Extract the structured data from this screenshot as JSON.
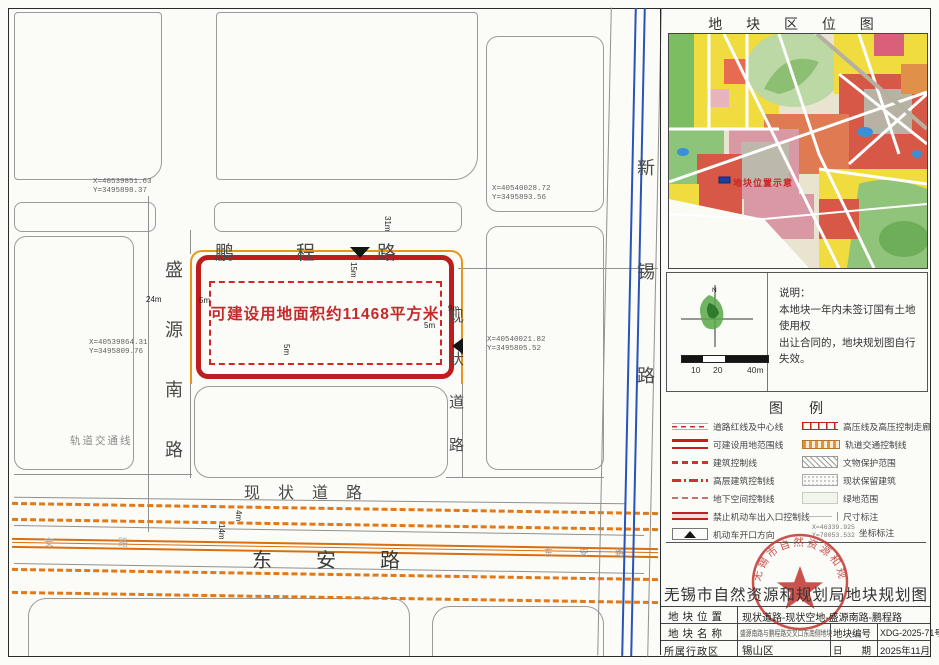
{
  "location_panel": {
    "title": "地 块 区 位 图",
    "map_label": "地块位置示意",
    "north_label": "N",
    "note_title": "说明：",
    "note_line1": "本地块一年内未签订国有土地使用权",
    "note_line2": "出让合同的，地块规划图自行失效。",
    "scale": {
      "t10": "10",
      "t20": "20",
      "t40": "40m"
    }
  },
  "legend": {
    "title": "图例",
    "left_items": [
      "道路红线及中心线",
      "可建设用地范围线",
      "建筑控制线",
      "高层建筑控制线",
      "地下空间控制线",
      "禁止机动车出入口控制线",
      "机动车开口方向"
    ],
    "right_items": [
      "高压线及高压控制走廊",
      "轨道交通控制线",
      "文物保护范围",
      "现状保留建筑",
      "绿地范围",
      "尺寸标注",
      "坐标标注"
    ],
    "coord_sample_x": "X=46339.925",
    "coord_sample_y": "Y=78053.532"
  },
  "title_block": {
    "title": "无锡市自然资源和规划局地块规划图",
    "seal_text": "无锡市自然资源和规划局",
    "dash_left": "—",
    "dash_right": "—",
    "loc_label": "地块位置",
    "loc_value": "现状道路-现状空地-盛源南路-鹏程路",
    "name_label": "地块名称",
    "name_value": "盛源南路与鹏程路交叉口东南侧地块",
    "code_label": "地块编号",
    "code_value": "XDG-2025-71号",
    "district_label": "所属行政区",
    "district_value": "锡山区",
    "date_label": "日　　期",
    "date_value": "2025年11月"
  },
  "map": {
    "parcel_text": "可建设用地面积约11468平方米",
    "roads": {
      "pengcheng": "鹏程路",
      "shengyuan": "盛源南路",
      "xianzhuang_v": "现状道路",
      "xianzhuang_h": "现状道路",
      "dongan": "东安路",
      "dongan_small": "东 安 路",
      "anlu_faint": "安路",
      "xinxi": "新锡路",
      "rail_label": "轨道交通线"
    },
    "coords": {
      "c1x": "X=40539851.63",
      "c1y": "Y=3495898.37",
      "c2x": "X=40540028.72",
      "c2y": "Y=3495893.56",
      "c3x": "X=40540021.82",
      "c3y": "Y=3495805.52",
      "c4x": "X=40539864.31",
      "c4y": "Y=3495809.76"
    },
    "dims": {
      "d31": "31m",
      "d15": "15m",
      "d24": "24m",
      "d5a": "5m",
      "d5b": "5m",
      "d5c": "5m",
      "d9": "9m",
      "d14": "14m",
      "d4": "4m"
    }
  }
}
